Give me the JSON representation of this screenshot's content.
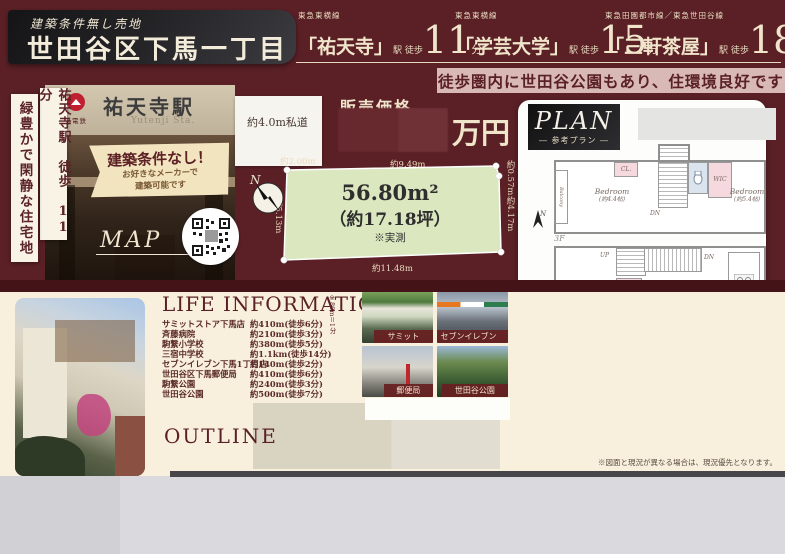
{
  "palette": {
    "maroon": "#5a2026",
    "cream": "#f0e5cb",
    "pink_band": "#d8b9b6",
    "lot_green": "#dbe7bf",
    "page_cream": "#f8f0dc",
    "caption_red": "#682021"
  },
  "header": {
    "condition": "建築条件無し売地",
    "title": "世田谷区下馬一丁目",
    "stations": [
      {
        "line": "東急東横線",
        "name": "「祐天寺」",
        "walk": "駅 徒歩",
        "min": "11",
        "unit": "分"
      },
      {
        "line": "東急東横線",
        "name": "「学芸大学」",
        "walk": "駅 徒歩",
        "min": "15",
        "unit": "分"
      },
      {
        "line": "東急田園都市線／東急世田谷線",
        "name": "「三軒茶屋」",
        "walk": "駅 徒歩",
        "min": "18",
        "unit": "分"
      }
    ],
    "park_note": "徒歩圏内に世田谷公園もあり、住環境良好です"
  },
  "left": {
    "catch1": "祐天寺駅 徒歩 11分",
    "catch2": "緑豊かで閑静な住宅地",
    "sign_name": "祐天寺駅",
    "sign_romaji": "Yutenji Sta.",
    "sign_company": "東急電鉄",
    "ribbon_title": "建築条件なし！",
    "ribbon_line1": "お好きなメーカーで",
    "ribbon_line2": "建築可能です",
    "map": "MAP"
  },
  "price": {
    "label": "販売価格",
    "unit": "万円"
  },
  "lot": {
    "road": "約4.0m私道",
    "road_w": "約2.00m",
    "area": "56.80m²",
    "tsubo": "（約17.18坪）",
    "measured": "※実測",
    "dim_top": "約9.49m",
    "dim_right_top": "約0.57m",
    "dim_right": "約4.17m",
    "dim_bottom": "約11.48m",
    "dim_left": "約5.13m",
    "north": "N"
  },
  "plan": {
    "title": "PLAN",
    "subtitle": "― 参考プラン ―",
    "north": "N",
    "f3": {
      "label": "3F",
      "balcony": "Balcony",
      "bed1": "Bedroom",
      "bed1_area": "(約4.4帖)",
      "cl": "CL.",
      "dn": "DN",
      "wic": "WIC",
      "bed2": "Bedroom",
      "bed2_area": "(約5.4帖)"
    },
    "f2": {
      "label": "2F",
      "up": "UP",
      "dn": "DN",
      "sto": "Sto.",
      "ldk": "LDK",
      "ldk_area": "(約20.4帖)"
    },
    "f1": {
      "label": "1F",
      "porch": "Porch",
      "shoes": "Shoes Box",
      "entrance": "Entrance",
      "up": "UP",
      "garage": "Inner Garage",
      "powder": "Powder Room",
      "bath": "Bath Room",
      "wic": "WIC",
      "service": "Service Room",
      "service_area": "(約6.8帖)"
    },
    "notes": [
      "※ボリューム参考プランの為、行政調査調整・構造計算等、詳細の検討は行っておりません。",
      "　1帖＝1.62m²にて表記しています。",
      "※参考プランの為、周辺中高層等による斜線の影響によって",
      "　同一の建築物が建築できない場合がございます。"
    ]
  },
  "life": {
    "heading": "LIFE INFORMATION",
    "scale_note": "※80m＝1分",
    "items": [
      {
        "name": "サミットストア下馬店",
        "dist": "約410m(徒歩6分)"
      },
      {
        "name": "斉藤病院",
        "dist": "約210m(徒歩3分)"
      },
      {
        "name": "駒繋小学校",
        "dist": "約380m(徒歩5分)"
      },
      {
        "name": "三宿中学校",
        "dist": "約1.1km(徒歩14分)"
      },
      {
        "name": "セブンイレブン下馬1丁目店",
        "dist": "約140m(徒歩2分)"
      },
      {
        "name": "世田谷区下馬郵便局",
        "dist": "約410m(徒歩6分)"
      },
      {
        "name": "駒繋公園",
        "dist": "約240m(徒歩3分)"
      },
      {
        "name": "世田谷公園",
        "dist": "約500m(徒歩7分)"
      }
    ],
    "photo_captions": [
      "サミット",
      "セブンイレブン",
      "郵便局",
      "世田谷公園"
    ]
  },
  "outline": {
    "heading": "OUTLINE"
  },
  "footer_note": "※図面と現況が異なる場合は、現況優先となります。"
}
